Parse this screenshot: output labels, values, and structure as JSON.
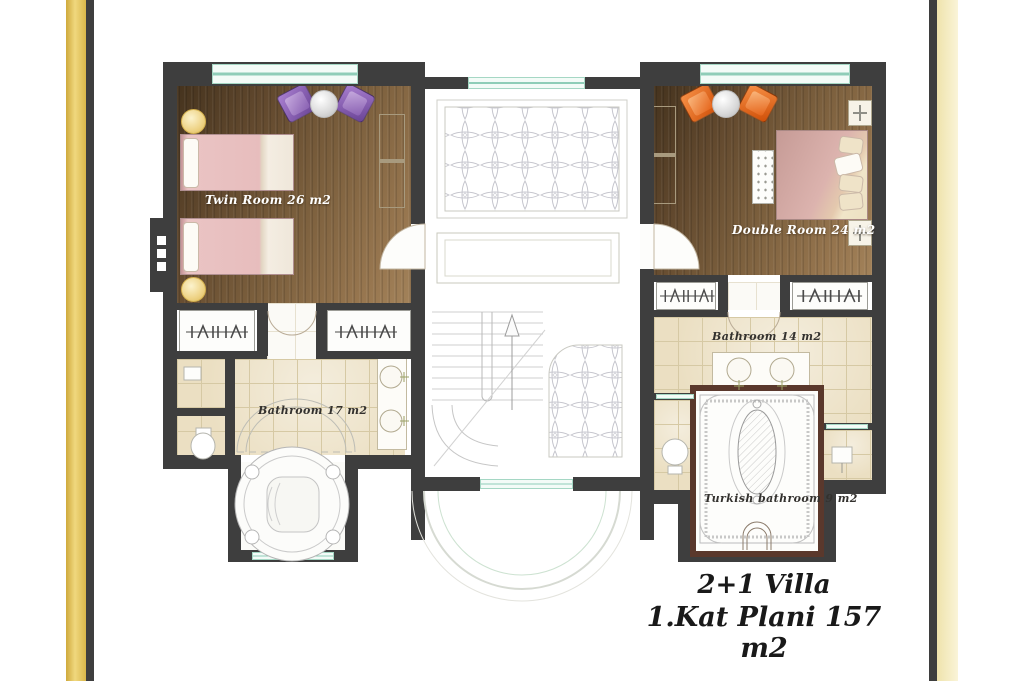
{
  "title": {
    "line1": "2+1 Villa",
    "line2": "1.Kat Plani 157 m2"
  },
  "rooms": {
    "twin_room": {
      "label": "Twin Room 26 m2"
    },
    "double_room": {
      "label": "Double Room 24 m2"
    },
    "bathroom_left": {
      "label": "Bathroom 17 m2"
    },
    "bathroom_right": {
      "label": "Bathroom 14 m2"
    },
    "turkish_bathroom": {
      "label": "Turkish bathroom 9 m2"
    }
  },
  "colors": {
    "wall": "#3e3e3e",
    "wood_floor": "#7a5f3f",
    "tile_floor": "#ebdfc2",
    "window_glass": "#cdeee2",
    "left_band_gold": "#e6c65a",
    "right_band_cream": "#f6eec4",
    "twin_bed_pink": "#e7bdbd",
    "double_bed_mauve": "#dcb3ae",
    "chair_left_purple": "#8a5fb5",
    "chair_right_orange": "#e8651a",
    "turkish_bath_border": "#5a382c",
    "room_label": "#ffffff",
    "bath_label": "#33312e",
    "title_text": "#191919"
  }
}
